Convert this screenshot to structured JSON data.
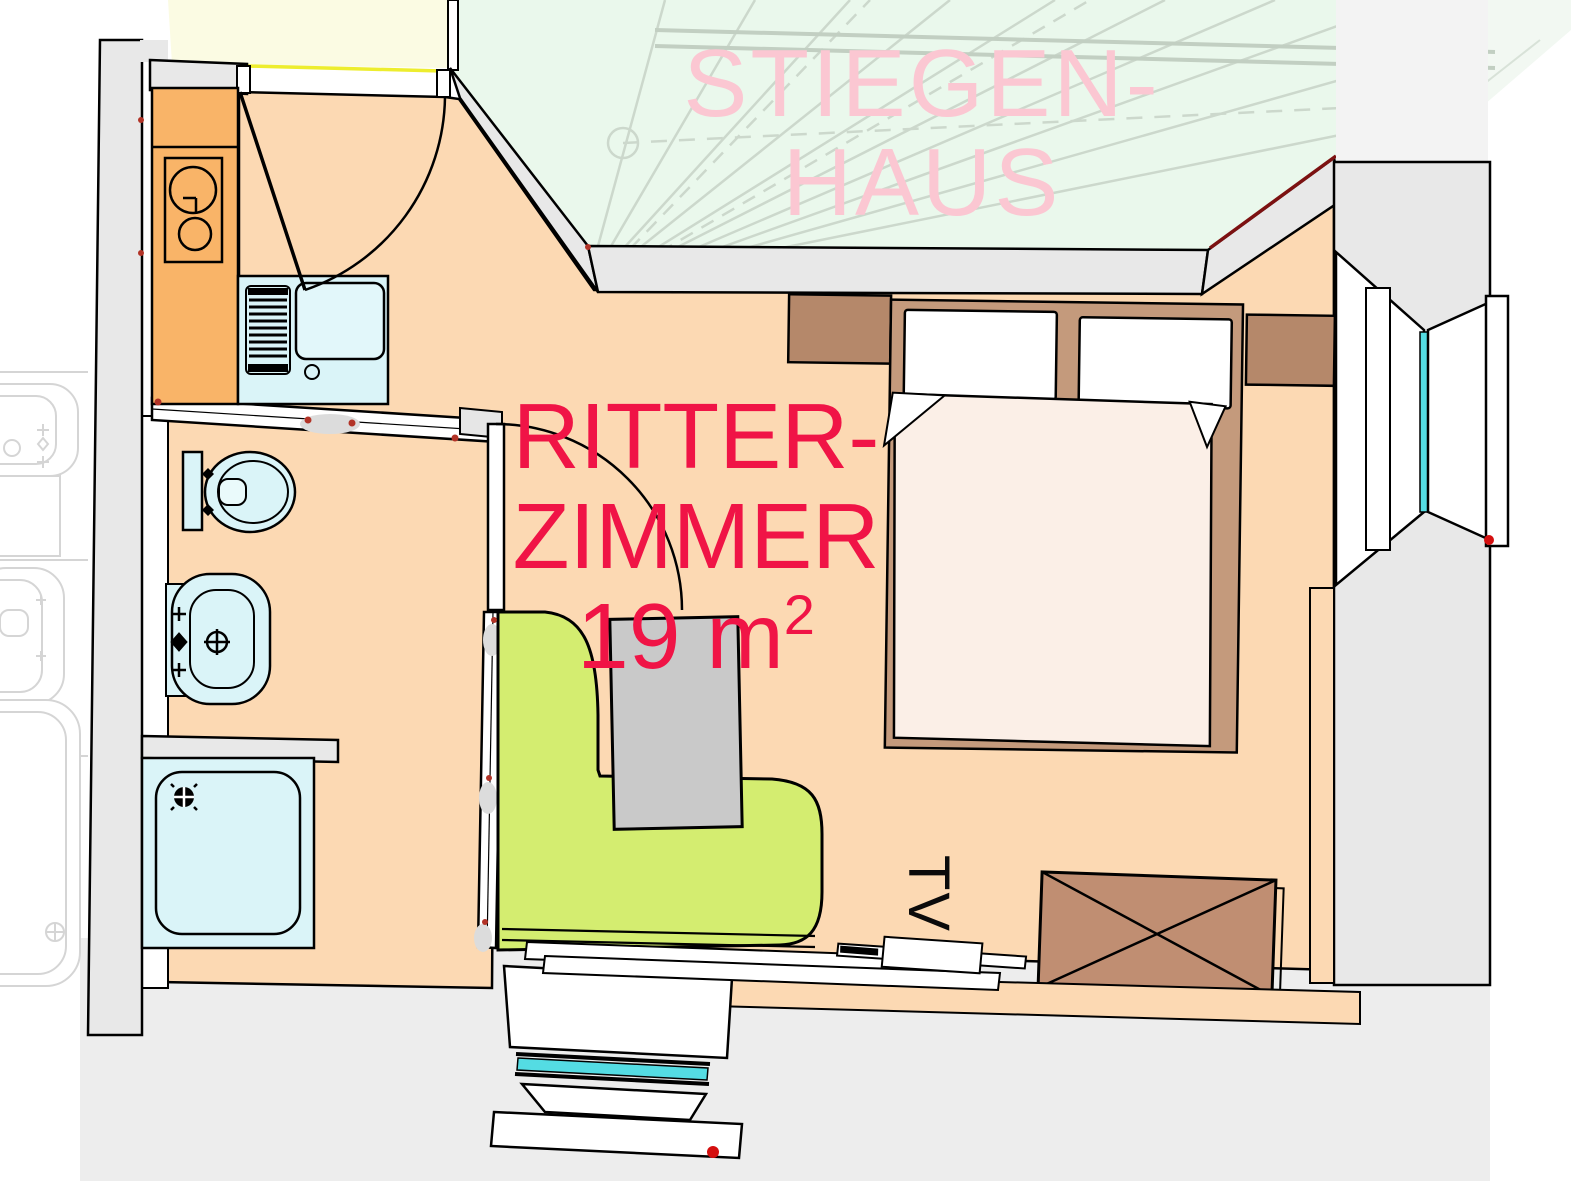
{
  "plan": {
    "stairwell_label_line1": "STIEGEN-",
    "stairwell_label_line2": "HAUS",
    "room_label_line1": "RITTER-",
    "room_label_line2": "ZIMMER",
    "room_area_value": "19 m",
    "room_area_superscript": "2",
    "tv_label": "TV"
  },
  "colors": {
    "room_floor": "#fcd9b3",
    "kitchen_counter": "#f9b468",
    "stairwell_fill": "#eaf8ec",
    "stairwell_label_pink": "#fbc7d2",
    "room_label_red": "#f01446",
    "corridor_yellow": "#fbfbe3",
    "threshold_yellow": "#eded2e",
    "wall_gray": "#e8e8e8",
    "outside_gray": "#ededed",
    "fixture_blue": "#daf4f8",
    "bench_green": "#d4ed70",
    "table_gray": "#c9c9c9",
    "bed_frame_brown": "#c49a7c",
    "bedside_brown": "#b5886a",
    "mattress_cream": "#fbefe7",
    "wardrobe_brown": "#c08e72",
    "window_glass_cyan": "#54dce3",
    "wall_accent_dark_red": "#7c1111",
    "marker_red": "#d40f0f"
  }
}
